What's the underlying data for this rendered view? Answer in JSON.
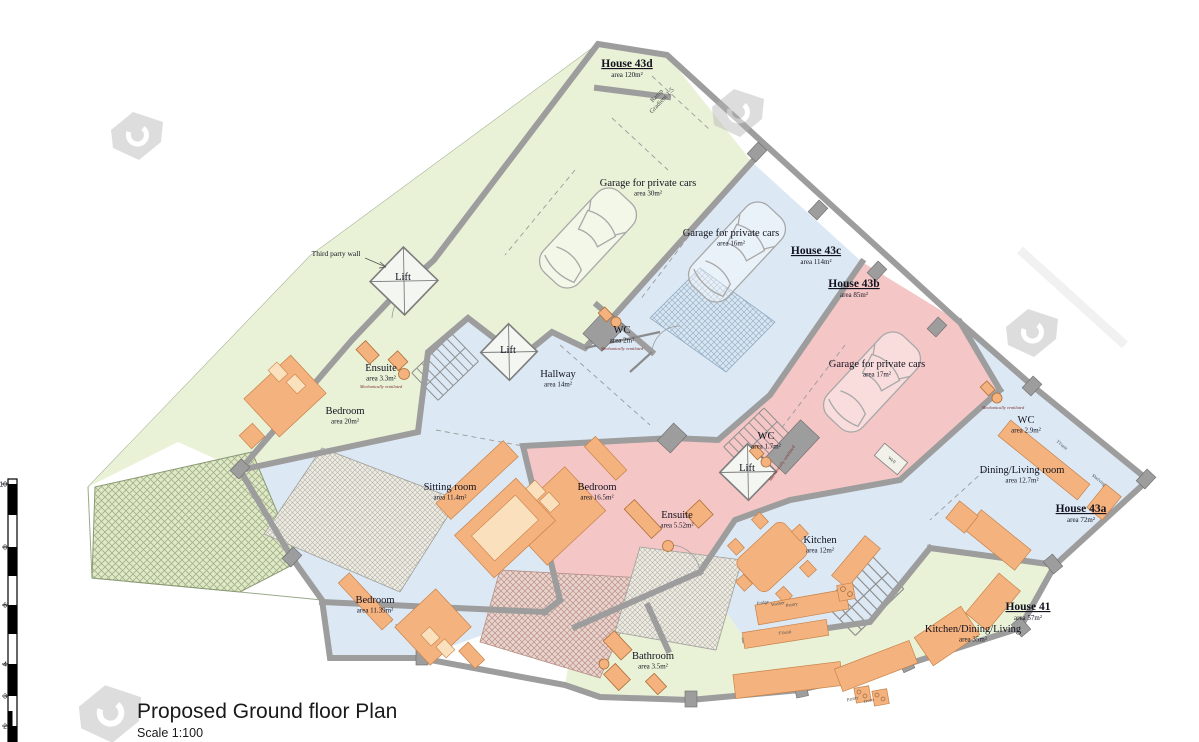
{
  "title": "Proposed Ground floor Plan",
  "scale_label": "Scale 1:100",
  "plan": {
    "houses": [
      {
        "label": "House 43d",
        "area": "area 120m²",
        "x": 627,
        "y": 67
      },
      {
        "label": "House 43c",
        "area": "area 114m²",
        "x": 816,
        "y": 254
      },
      {
        "label": "House 43b",
        "area": "area 85m²",
        "x": 854,
        "y": 287
      },
      {
        "label": "House 43a",
        "area": "area 72m²",
        "x": 1081,
        "y": 512
      },
      {
        "label": "House 41",
        "area": "area 57m²",
        "x": 1028,
        "y": 610
      }
    ],
    "rooms": [
      {
        "name": "Garage for private cars",
        "area": "area 30m²",
        "x": 648,
        "y": 186
      },
      {
        "name": "Garage for private cars",
        "area": "area 16m²",
        "x": 731,
        "y": 236
      },
      {
        "name": "Garage for private cars",
        "area": "area 17m²",
        "x": 877,
        "y": 367
      },
      {
        "name": "Lift",
        "area": null,
        "x": 403,
        "y": 280
      },
      {
        "name": "Ensuite",
        "area": "area 3.3m²",
        "x": 381,
        "y": 371
      },
      {
        "name": "Bedroom",
        "area": "area 20m²",
        "x": 345,
        "y": 414
      },
      {
        "name": "Lift",
        "area": null,
        "x": 508,
        "y": 353
      },
      {
        "name": "Hallway",
        "area": "area 14m²",
        "x": 558,
        "y": 377
      },
      {
        "name": "WC",
        "area": "area 2m²",
        "x": 622,
        "y": 333
      },
      {
        "name": "WC",
        "area": "area 1.7m²",
        "x": 766,
        "y": 439
      },
      {
        "name": "Lift",
        "area": null,
        "x": 747,
        "y": 471
      },
      {
        "name": "WC",
        "area": "area 2.9m²",
        "x": 1026,
        "y": 423
      },
      {
        "name": "Dining/Living room",
        "area": "area 12.7m²",
        "x": 1022,
        "y": 473
      },
      {
        "name": "Sitting room",
        "area": "area 11.4m²",
        "x": 450,
        "y": 490
      },
      {
        "name": "Bedroom",
        "area": "area 16.5m²",
        "x": 597,
        "y": 490
      },
      {
        "name": "Ensuite",
        "area": "area 5.52m²",
        "x": 677,
        "y": 518
      },
      {
        "name": "Kitchen",
        "area": "area 12m²",
        "x": 820,
        "y": 543
      },
      {
        "name": "Bedroom",
        "area": "area 11.39m²",
        "x": 375,
        "y": 603
      },
      {
        "name": "Bathroom",
        "area": "area 3.5m²",
        "x": 653,
        "y": 659
      },
      {
        "name": "Kitchen/Dining/Living",
        "area": "area 35m²",
        "x": 973,
        "y": 632
      }
    ],
    "notes": [
      {
        "text": "Mechanically ventilated",
        "x": 381,
        "y": 388,
        "rot": 0
      },
      {
        "text": "Mechanically ventilated",
        "x": 622,
        "y": 350,
        "rot": 0
      },
      {
        "text": "Mechanically ventilated",
        "x": 1003,
        "y": 409,
        "rot": 0
      },
      {
        "text": "Mechanically ventilated",
        "x": 783,
        "y": 464,
        "rot": -55
      }
    ],
    "annotations": {
      "third_party_wall": {
        "text": "Third party wall",
        "x": 336,
        "y": 256
      },
      "ramp": {
        "line1": "Ramp",
        "line2": "Gradient 1:5",
        "x": 658,
        "y": 97,
        "rot": -47
      },
      "well": {
        "text": "Well",
        "x": 891,
        "y": 461,
        "rot": 40
      }
    },
    "furniture_labels": [
      {
        "text": "TVunit",
        "x": 1061,
        "y": 446,
        "rot": 39
      },
      {
        "text": "Shelving",
        "x": 1098,
        "y": 481,
        "rot": 39
      },
      {
        "text": "TVunit",
        "x": 785,
        "y": 634,
        "rot": -9
      },
      {
        "text": "Fridge",
        "x": 763,
        "y": 604,
        "rot": -10
      },
      {
        "text": "Washer",
        "x": 778,
        "y": 605,
        "rot": -10
      },
      {
        "text": "Pantry",
        "x": 792,
        "y": 606,
        "rot": -10
      },
      {
        "text": "Pantry",
        "x": 853,
        "y": 700,
        "rot": -14
      },
      {
        "text": "Oven",
        "x": 869,
        "y": 702,
        "rot": -14
      }
    ],
    "scale_bar": {
      "numbers": [
        {
          "label": "10",
          "y": 484
        },
        {
          "label": "8",
          "y": 547
        },
        {
          "label": "6",
          "y": 605
        },
        {
          "label": "4",
          "y": 664
        },
        {
          "label": "3",
          "y": 696
        },
        {
          "label": "2",
          "y": 726
        }
      ]
    },
    "colors": {
      "house_green": "#e9f2d7",
      "house_blue": "#dce9f5",
      "house_pink": "#f5c6c6",
      "wall_grey": "#9d9d9d",
      "furniture_orange": "#f4b27e"
    }
  }
}
